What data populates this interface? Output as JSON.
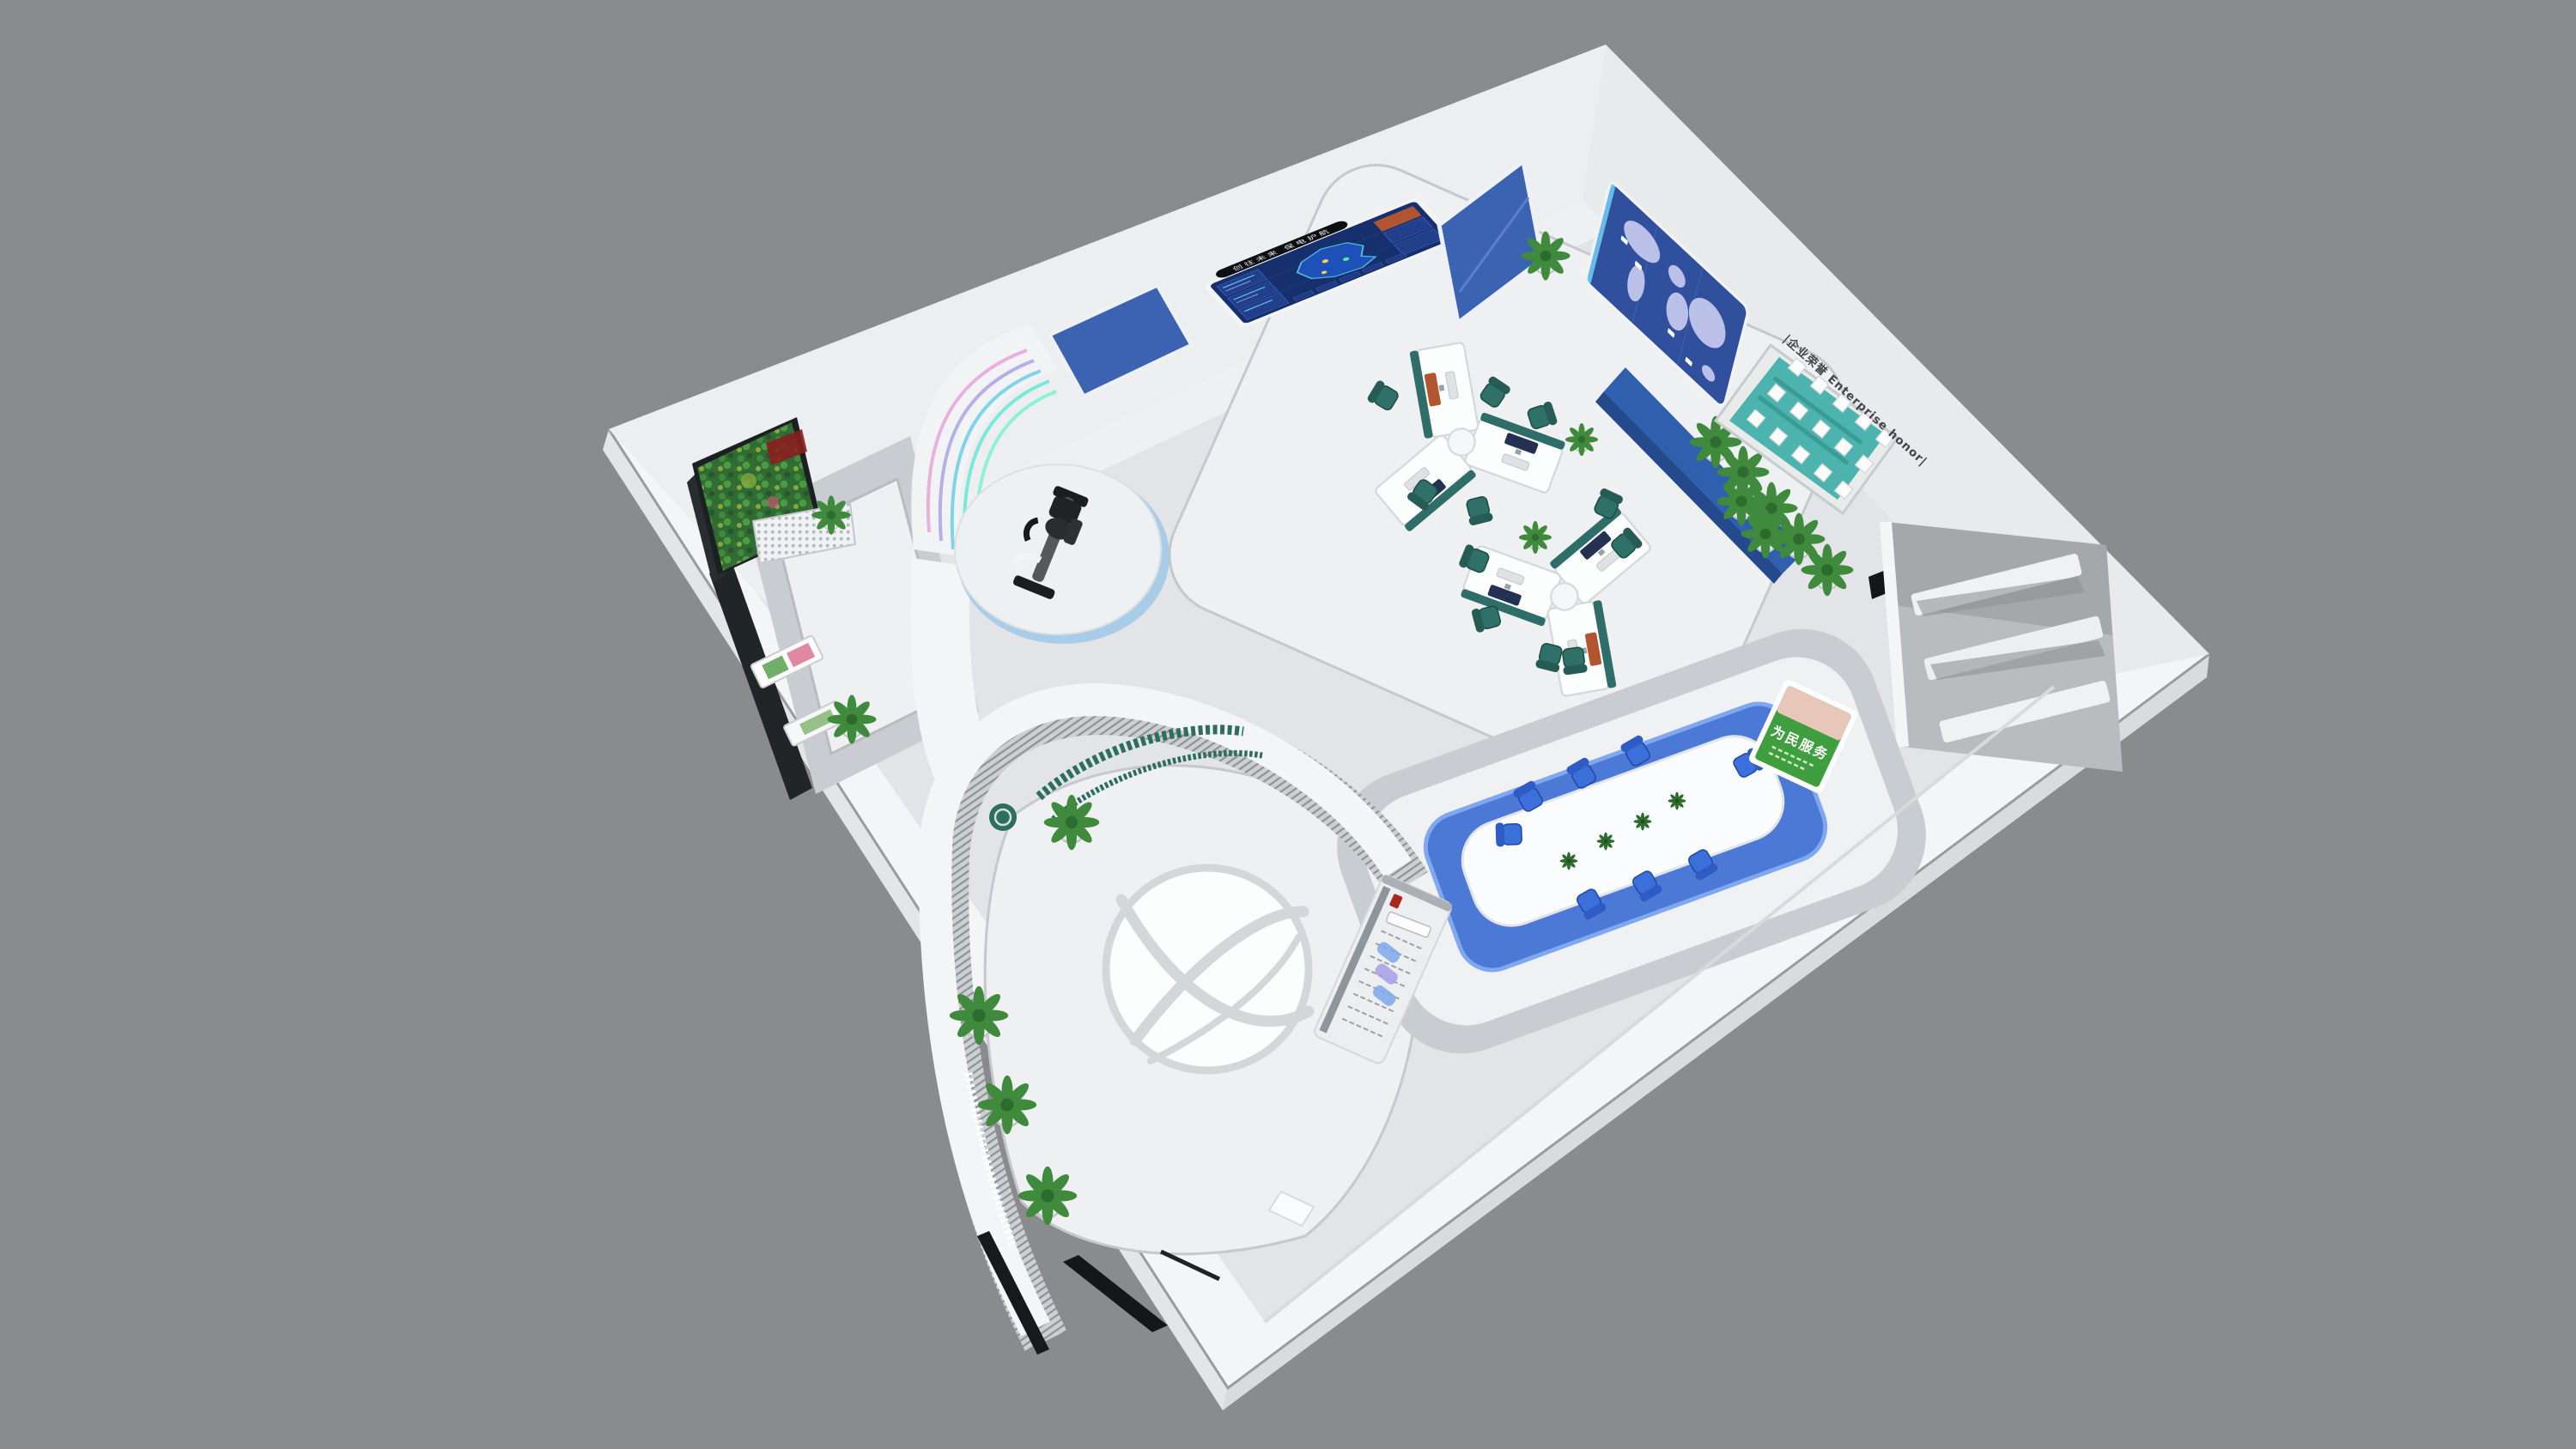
{
  "scene": {
    "description": "3D isometric render of a corporate smart-showroom exhibition hall, cut-open bird's-eye view",
    "background_color": "#8a8b8d",
    "floor_logo": "globe-swoosh-emblem"
  },
  "displays": {
    "main_screen": {
      "header_text": "创往未来 保电护航",
      "type": "blue data dashboard with glowing province map"
    },
    "side_panel_left": "blank blue glass panel",
    "side_panel_right": "blank blue glass panel",
    "world_map_wall": "dotted world map on blue panel with location tags",
    "honor_wall": {
      "title": "|企业荣誉 Enterprise honor|",
      "plaque_count": 15,
      "shelf_color": "#4cb3ae"
    },
    "service_poster": {
      "text": "为民服务"
    },
    "culture_panel": "white timeline culture display with red seal and blue glass decor"
  },
  "furniture": {
    "workstation_pods": 2,
    "workstation_chairs": 11,
    "workstation_chair_color": "#2f7068",
    "conference_tables": 1,
    "conference_chairs": 8,
    "conference_chair_color": "#3b6fd9",
    "conference_table_mini_plants": 4,
    "exercise_bike_platform": 1,
    "curved_slogan_wall": 1,
    "green_plant_wall": 1,
    "potted_plants_right_wall": 5,
    "potted_plants_walkway": 4,
    "honor_shelf_plants": 2,
    "leaning_poster_frames": 2
  },
  "colors": {
    "background": "#8a8b8d",
    "slab_white": "#f4f5f6",
    "floor_gray": "#e2e4e7",
    "screen_blue": "#3c63b2",
    "dashboard_navy": "#16306e",
    "map_cyan": "#5fc8f0",
    "teal_chair": "#2f7068",
    "blue_chair": "#3b6fd9",
    "honor_teal": "#4cb3ae",
    "poster_green": "#3f9f3f",
    "neon_pink": "#e8b0dc",
    "neon_cyan": "#7fd4ea"
  }
}
